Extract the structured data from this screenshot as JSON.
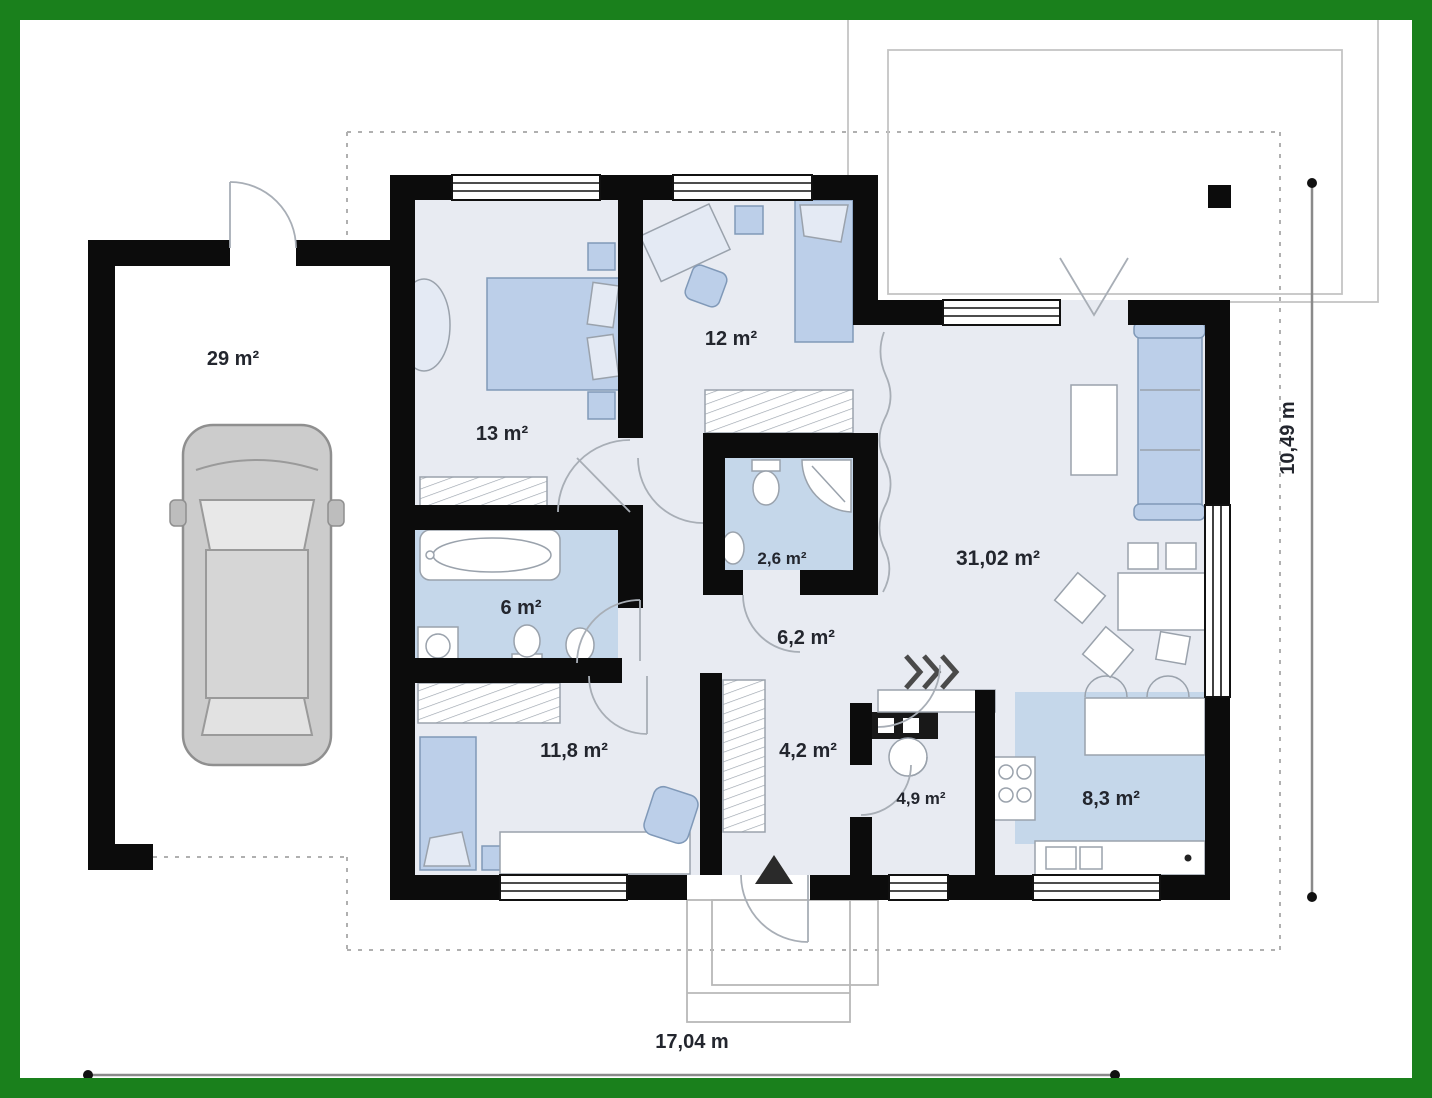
{
  "plan": {
    "rooms": [
      {
        "id": "garage",
        "area": "29 m²"
      },
      {
        "id": "bedroom-1",
        "area": "13 m²"
      },
      {
        "id": "bedroom-2",
        "area": "12 m²"
      },
      {
        "id": "wc",
        "area": "2,6 m²"
      },
      {
        "id": "bathroom",
        "area": "6 m²"
      },
      {
        "id": "hall",
        "area": "6,2 m²"
      },
      {
        "id": "living-room",
        "area": "31,02 m²"
      },
      {
        "id": "bedroom-3",
        "area": "11,8 m²"
      },
      {
        "id": "hall-2",
        "area": "4,2 m²"
      },
      {
        "id": "entry",
        "area": "4,9 m²"
      },
      {
        "id": "kitchen",
        "area": "8,3 m²"
      }
    ],
    "dimensions": {
      "width": "17,04 m",
      "height": "10,49 m"
    },
    "colors": {
      "border": "#1a801c",
      "wall": "#0c0c0c",
      "floor": "#e8ebf2",
      "wet_floor": "#c5d7ea",
      "furniture": "#bccfe9"
    }
  }
}
